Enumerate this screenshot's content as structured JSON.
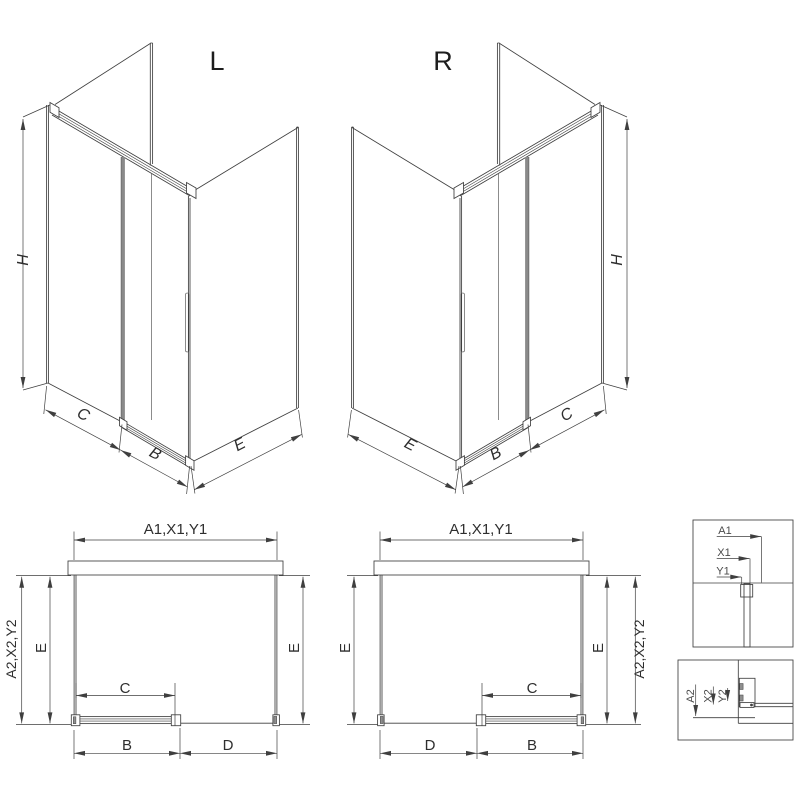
{
  "iso_left": {
    "variant": "L",
    "h": "H",
    "c": "C",
    "b": "B",
    "e": "E"
  },
  "iso_right": {
    "variant": "R",
    "h": "H",
    "e": "E",
    "b": "B",
    "c": "C"
  },
  "plan_left": {
    "width_top": "A1,X1,Y1",
    "width_side": "A2,X2,Y2",
    "depth_left": "E",
    "depth_right": "E",
    "opening": "C",
    "door": "B",
    "fixed": "D"
  },
  "plan_right": {
    "width_top": "A1,X1,Y1",
    "width_side": "A2,X2,Y2",
    "depth_left": "E",
    "depth_right": "E",
    "opening": "C",
    "fixed": "D",
    "door": "B"
  },
  "detail_top": {
    "a1": "A1",
    "x1": "X1",
    "y1": "Y1"
  },
  "detail_bottom": {
    "a2": "A2",
    "x2": "X2",
    "y2": "Y2"
  },
  "colors": {
    "line": "#3f3f3f",
    "door_edge": "#8a8a8a",
    "background": "#ffffff"
  }
}
